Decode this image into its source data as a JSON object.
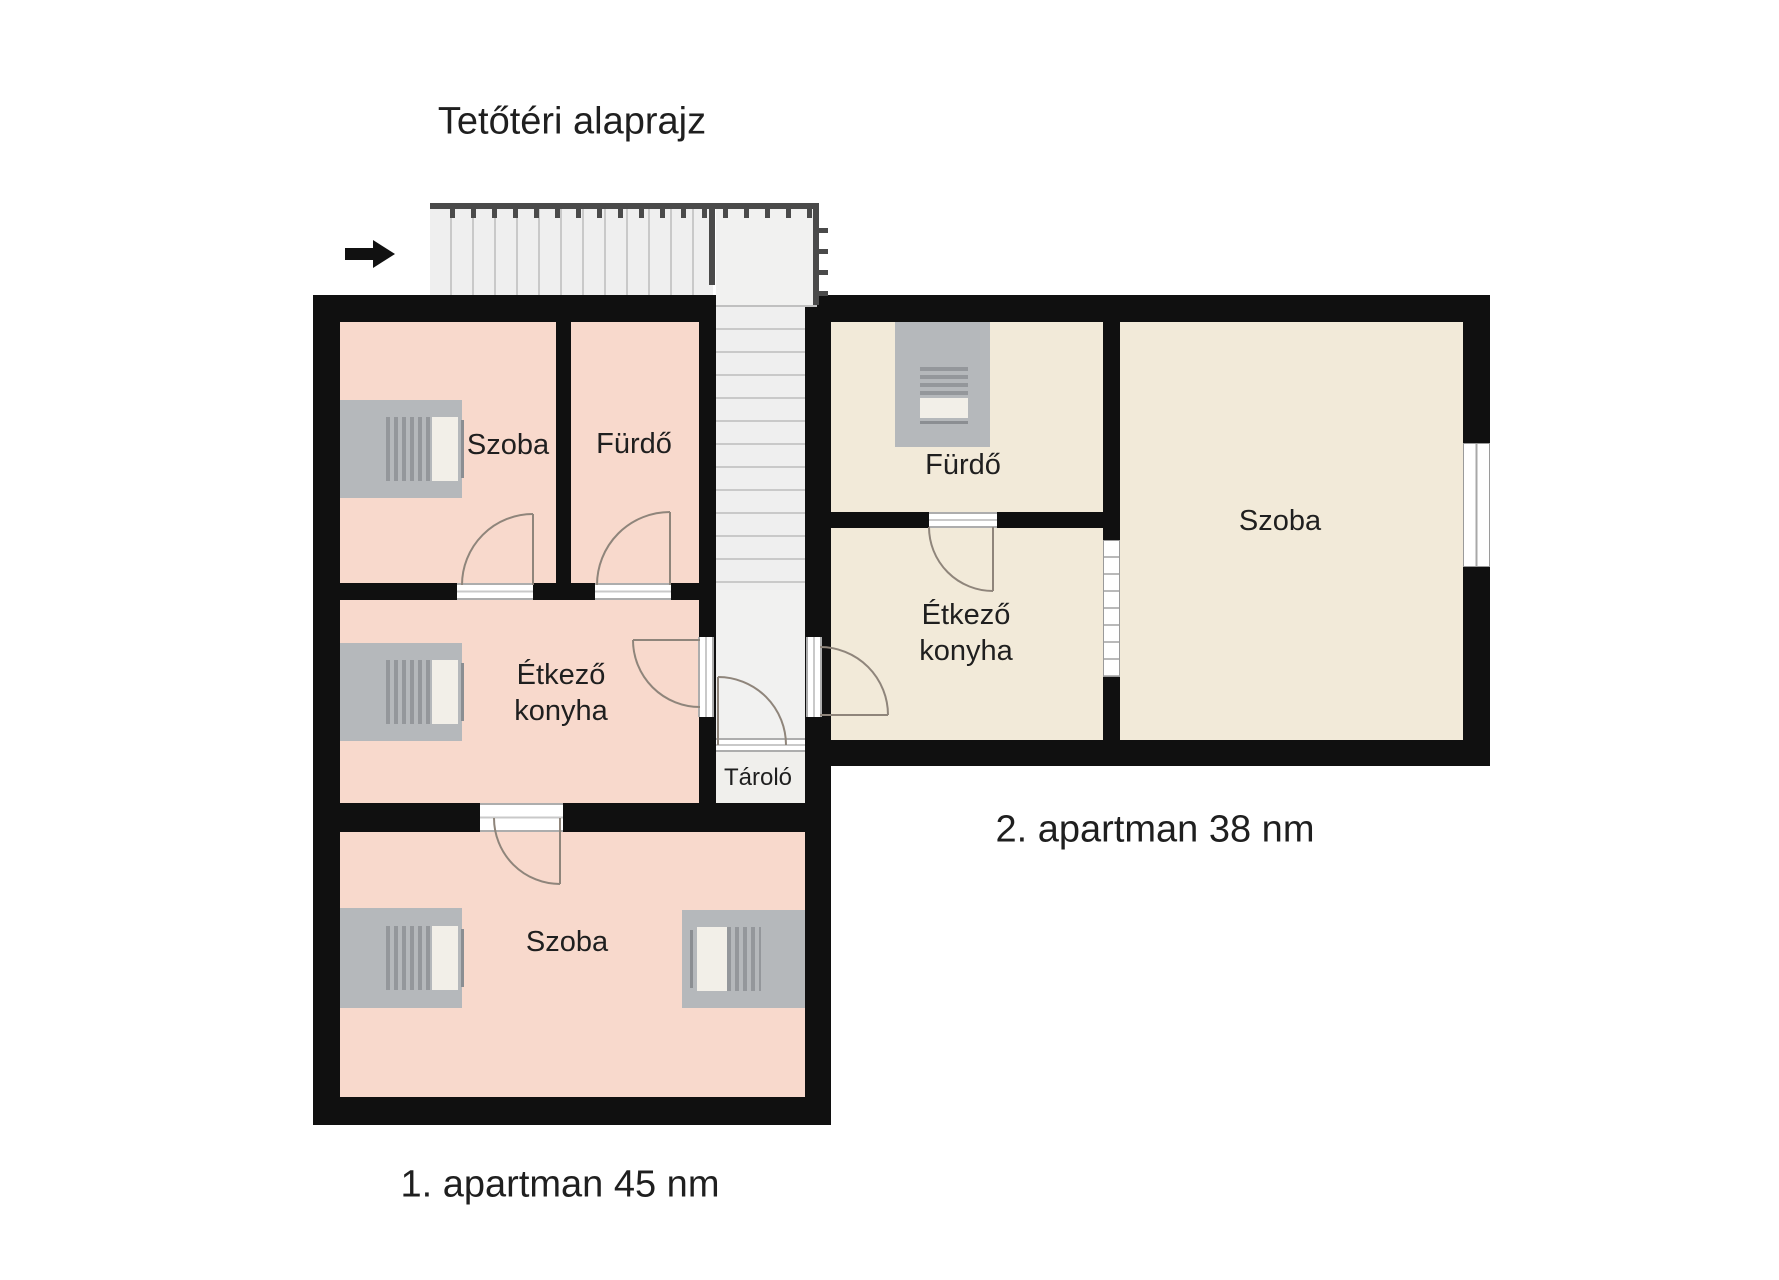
{
  "title": "Tetőtéri alaprajz",
  "apartment1": {
    "label": "1. apartman 45 nm",
    "szoba_top": "Szoba",
    "furdo": "Fürdő",
    "etkezo1": "Étkező",
    "etkezo2": "konyha",
    "szoba_bottom": "Szoba"
  },
  "apartment2": {
    "label": "2. apartman 38 nm",
    "furdo": "Fürdő",
    "etkezo1": "Étkező",
    "etkezo2": "konyha",
    "szoba": "Szoba"
  },
  "storage": {
    "label": "Tároló"
  },
  "colors": {
    "wall": "#101010",
    "apt1-room": "#f8d9cc",
    "apt2-room": "#f2ead9",
    "stair-fill": "#efefef",
    "stair-line": "#c9c9c9",
    "landing-fill": "#f1f1f0",
    "storage-fill": "#f0efec",
    "furniture": "#b5b8bb",
    "furniture-stripe": "#94979b",
    "furniture-light": "#f2efe8",
    "door-arc": "#8f857b",
    "rail": "#4a4a4a",
    "text": "#1f1f1f"
  }
}
